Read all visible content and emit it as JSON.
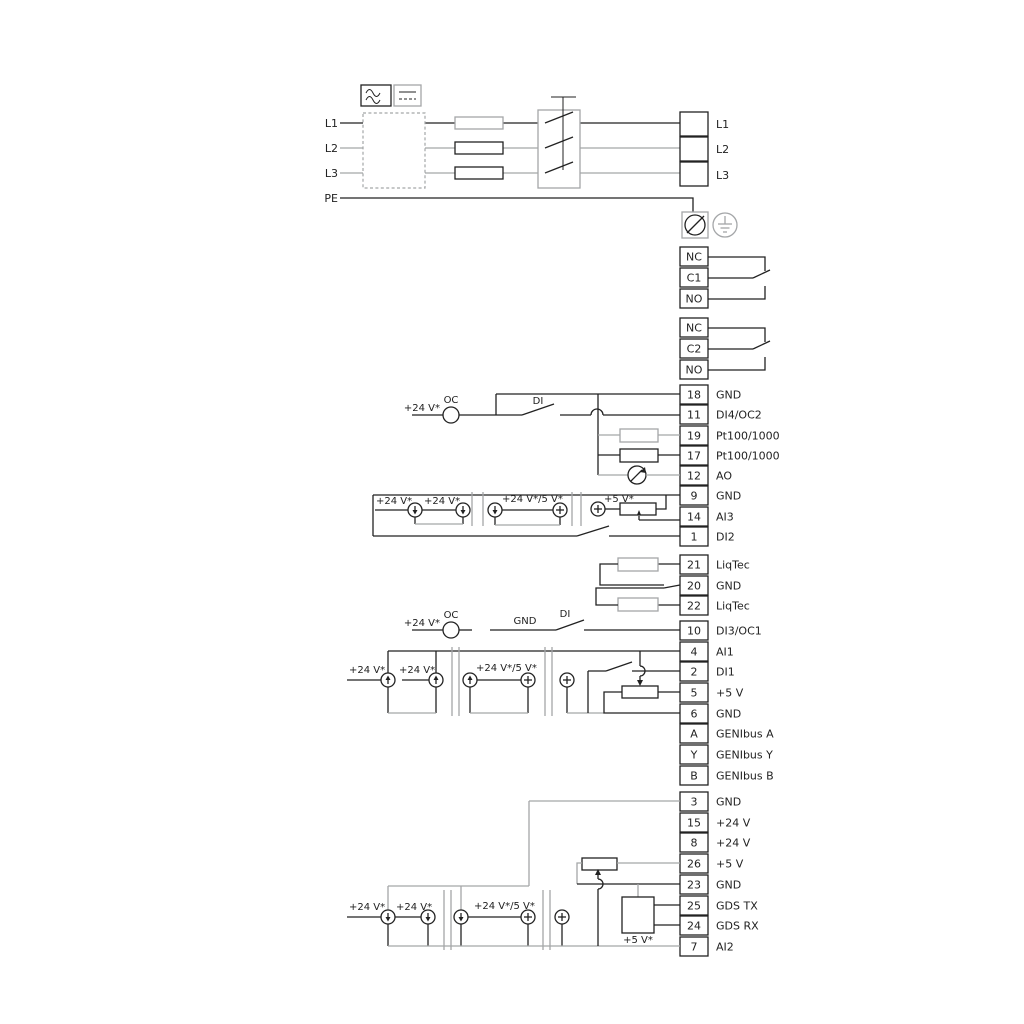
{
  "colors": {
    "line_black": "#222222",
    "line_gray": "#a4a6a8"
  },
  "power": {
    "inputs": [
      {
        "label": "L1"
      },
      {
        "label": "L2"
      },
      {
        "label": "L3"
      },
      {
        "label": "PE"
      }
    ],
    "output_block": [
      {
        "label": "L1"
      },
      {
        "label": "L2"
      },
      {
        "label": "L3"
      }
    ]
  },
  "relay1": {
    "cells": [
      {
        "label": "NC"
      },
      {
        "label": "C1"
      },
      {
        "label": "NO"
      }
    ]
  },
  "relay2": {
    "cells": [
      {
        "label": "NC"
      },
      {
        "label": "C2"
      },
      {
        "label": "NO"
      }
    ]
  },
  "strips": {
    "a": [
      {
        "no": "18",
        "label": "GND"
      },
      {
        "no": "11",
        "label": "DI4/OC2"
      },
      {
        "no": "19",
        "label": "Pt100/1000"
      },
      {
        "no": "17",
        "label": "Pt100/1000"
      },
      {
        "no": "12",
        "label": "AO"
      },
      {
        "no": "9",
        "label": "GND"
      },
      {
        "no": "14",
        "label": "AI3"
      },
      {
        "no": "1",
        "label": "DI2"
      }
    ],
    "b": [
      {
        "no": "21",
        "label": "LiqTec"
      },
      {
        "no": "20",
        "label": "GND"
      },
      {
        "no": "22",
        "label": "LiqTec"
      }
    ],
    "c": [
      {
        "no": "10",
        "label": "DI3/OC1"
      },
      {
        "no": "4",
        "label": "AI1"
      },
      {
        "no": "2",
        "label": "DI1"
      },
      {
        "no": "5",
        "label": "+5 V"
      },
      {
        "no": "6",
        "label": "GND"
      },
      {
        "no": "A",
        "label": "GENIbus A"
      },
      {
        "no": "Y",
        "label": "GENIbus Y"
      },
      {
        "no": "B",
        "label": "GENIbus B"
      }
    ],
    "d": [
      {
        "no": "3",
        "label": "GND"
      },
      {
        "no": "15",
        "label": "+24 V"
      },
      {
        "no": "8",
        "label": "+24 V"
      },
      {
        "no": "26",
        "label": "+5 V"
      },
      {
        "no": "23",
        "label": "GND"
      },
      {
        "no": "25",
        "label": "GDS TX"
      },
      {
        "no": "24",
        "label": "GDS RX"
      },
      {
        "no": "7",
        "label": "AI2"
      }
    ]
  },
  "annotations": {
    "di4": {
      "v24": "+24 V*",
      "oc": "OC",
      "di": "DI"
    },
    "ai3": {
      "v24a": "+24 V*",
      "v24b": "+24 V*",
      "v24_5": "+24 V*/5 V*",
      "v5": "+5 V*"
    },
    "di3": {
      "v24": "+24 V*",
      "oc": "OC",
      "gnd": "GND",
      "di": "DI"
    },
    "ai1": {
      "v24a": "+24 V*",
      "v24b": "+24 V*",
      "v24_5": "+24 V*/5 V*"
    },
    "ai2": {
      "v24a": "+24 V*",
      "v24b": "+24 V*",
      "v24_5": "+24 V*/5 V*",
      "v5": "+5 V*"
    }
  }
}
